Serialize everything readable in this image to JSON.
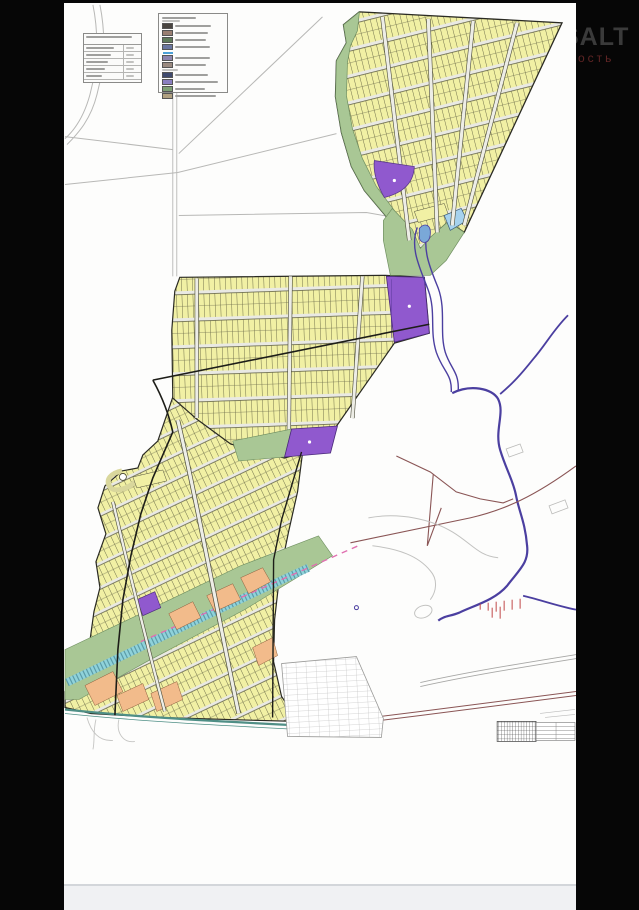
{
  "watermark": {
    "line1": "SALT",
    "line2": "ость"
  },
  "map": {
    "type": "cadastral-land-plot-scheme",
    "palette": {
      "parcel_yellow": "#f1f0a4",
      "parcel_line": "#6b6b3f",
      "road_white": "#ededE6",
      "road_edge": "#4a4a38",
      "greenery": "#a9c795",
      "purple_block": "#9059ce",
      "lightblue_block": "#a6d2ee",
      "railway_cyan": "#8fd2da",
      "river_blue": "#4b3fa0",
      "orange_parcel": "#f2bb8b",
      "pink_dashed": "#e070b0",
      "brown_road": "#8a5555",
      "boundary_black": "#1d1d18",
      "field_line_gray": "#b8b8b6"
    },
    "legend": {
      "groups": [
        {
          "items": [
            {
              "color": "#4a4540"
            },
            {
              "color": "#9a7f72"
            },
            {
              "color": "#5f7a5a"
            },
            {
              "color": "#6a76a0"
            }
          ]
        },
        {
          "line_color": "#4aa0d8",
          "items": [
            {
              "color": "#8b84ae"
            },
            {
              "color": "#9a8a80"
            }
          ]
        },
        {
          "items": [
            {
              "color": "#3f4a6e"
            },
            {
              "color": "#8a7fc0"
            },
            {
              "color": "#7fa075"
            },
            {
              "color": "#b0a080"
            }
          ]
        }
      ]
    },
    "info_table": {
      "columns": 2,
      "rows": 5
    }
  }
}
